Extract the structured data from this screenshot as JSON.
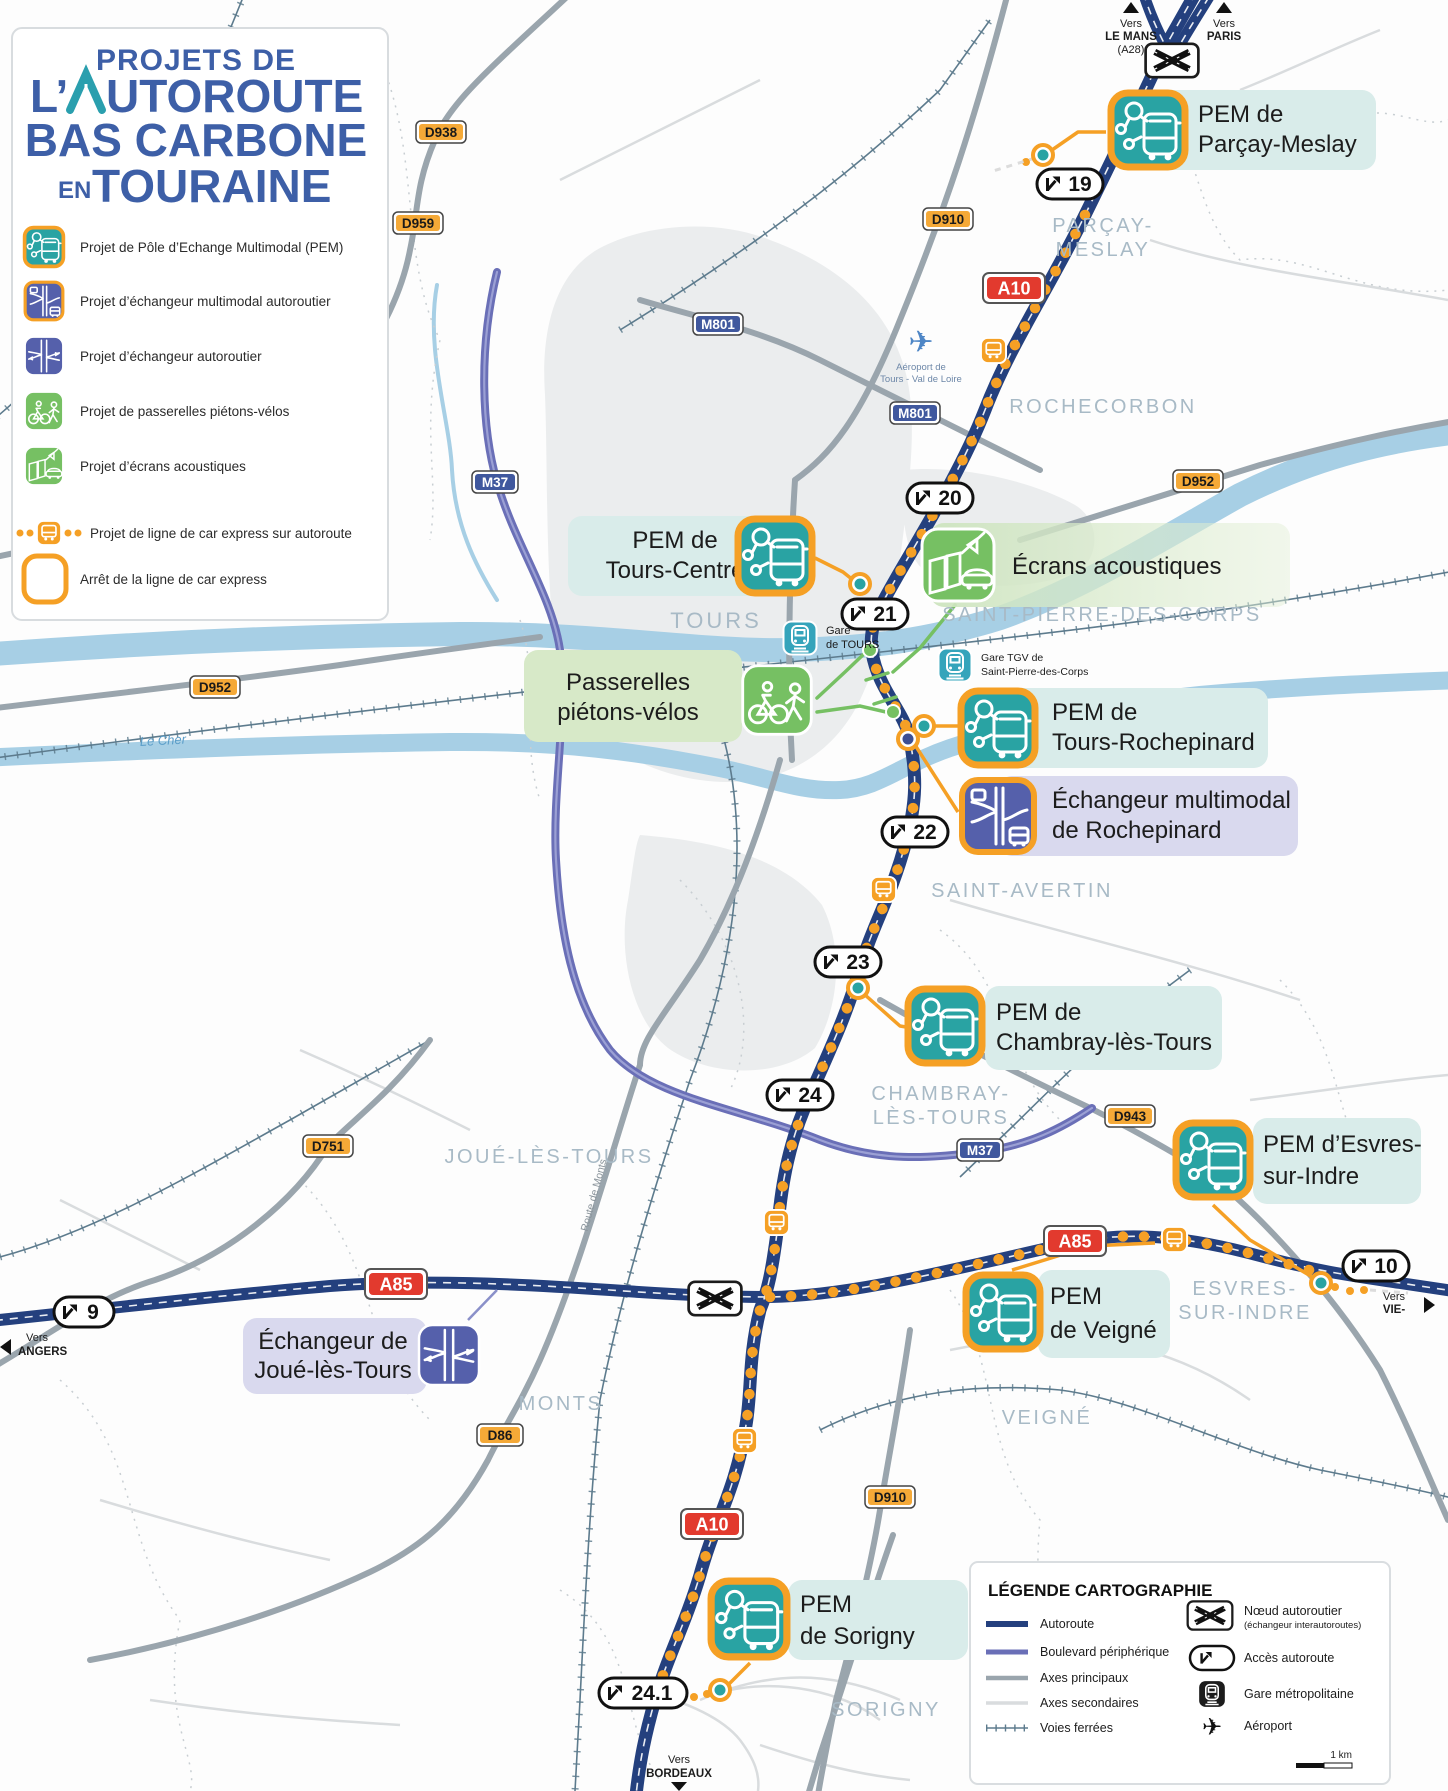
{
  "title_box": {
    "line1": "PROJETS DE",
    "line2_prefix": "L’",
    "line2_rest": "UTOROUTE",
    "line3": "BAS CARBONE",
    "line4_prefix": "EN",
    "line4_rest": "TOURAINE",
    "legend_items": [
      {
        "icon": "pem-icon",
        "label": "Projet de Pôle d’Echange Multimodal (PEM)"
      },
      {
        "icon": "echangeur-multimodal-icon",
        "label": "Projet d’échangeur multimodal autoroutier"
      },
      {
        "icon": "echangeur-autoroutier-icon",
        "label": "Projet d’échangeur autoroutier"
      },
      {
        "icon": "passerelles-icon",
        "label": "Projet de passerelles piétons-vélos"
      },
      {
        "icon": "ecrans-acoustiques-icon",
        "label": "Projet d’écrans acoustiques"
      },
      {
        "icon": "car-express-icon",
        "label": "Projet de ligne de car express sur autoroute"
      },
      {
        "icon": "arret-car-express-icon",
        "label": "Arrêt de la ligne de car express"
      }
    ]
  },
  "callouts": [
    {
      "kind": "pem",
      "lines": [
        "PEM de",
        "Parçay-Meslay"
      ]
    },
    {
      "kind": "pem",
      "lines": [
        "PEM de",
        "Tours-Centre"
      ]
    },
    {
      "kind": "ecrans",
      "lines": [
        "Écrans acoustiques"
      ]
    },
    {
      "kind": "passerelles",
      "lines": [
        "Passerelles",
        "piétons-vélos"
      ]
    },
    {
      "kind": "pem",
      "lines": [
        "PEM de",
        "Tours-Rochepinard"
      ]
    },
    {
      "kind": "echangeur",
      "lines": [
        "Échangeur multimodal",
        "de Rochepinard"
      ]
    },
    {
      "kind": "pem",
      "lines": [
        "PEM de",
        "Chambray-lès-Tours"
      ]
    },
    {
      "kind": "pem",
      "lines": [
        "PEM d’Esvres-",
        "sur-Indre"
      ]
    },
    {
      "kind": "pem",
      "lines": [
        "PEM",
        "de Veigné"
      ]
    },
    {
      "kind": "echangeur",
      "lines": [
        "Échangeur de",
        "Joué-lès-Tours"
      ]
    },
    {
      "kind": "pem",
      "lines": [
        "PEM",
        "de Sorigny"
      ]
    }
  ],
  "junctions": [
    "19",
    "20",
    "21",
    "22",
    "23",
    "24",
    "24.1",
    "9",
    "10"
  ],
  "road_badges": {
    "d": [
      "D938",
      "D959",
      "D910",
      "D952",
      "D952",
      "D751",
      "D943",
      "D86",
      "D910"
    ],
    "m": [
      "M801",
      "M801",
      "M37",
      "M37"
    ],
    "a": [
      "A10",
      "A10",
      "A85",
      "A85"
    ]
  },
  "cities": [
    [
      "PARÇAY-",
      "MESLAY"
    ],
    [
      "ROCHECORBON"
    ],
    [
      "TOURS"
    ],
    [
      "SAINT-PIERRE-DES-CORPS"
    ],
    [
      "SAINT-AVERTIN"
    ],
    [
      "CHAMBRAY-",
      "LÈS-TOURS"
    ],
    [
      "JOUÉ-LÈS-TOURS"
    ],
    [
      "ESVRES-",
      "SUR-INDRE"
    ],
    [
      "MONTS"
    ],
    [
      "VEIGNÉ"
    ],
    [
      "SORIGNY"
    ]
  ],
  "directions": [
    [
      "Vers",
      "LE MANS",
      "(A28)"
    ],
    [
      "Vers",
      "PARIS"
    ],
    [
      "Vers",
      "VIE-"
    ],
    [
      "Vers",
      "ANGERS"
    ],
    [
      "Vers",
      "BORDEAUX"
    ]
  ],
  "stations": {
    "gare_tours": [
      "Gare",
      "de TOURS"
    ],
    "gare_tgv": [
      "Gare TGV de",
      "Saint-Pierre-des-Corps"
    ],
    "airport": [
      "Aéroport de",
      "Tours - Val de Loire"
    ]
  },
  "rivers": {
    "loire": "La Loire",
    "cher": "Le Cher"
  },
  "minor_labels": {
    "route_de_monts": "Route de Monts"
  },
  "legend_carto": {
    "title": "LÉGENDE CARTOGRAPHIE",
    "lines": [
      {
        "label": "Autoroute"
      },
      {
        "label": "Boulevard périphérique"
      },
      {
        "label": "Axes principaux"
      },
      {
        "label": "Axes secondaires"
      },
      {
        "label": "Voies ferrées"
      }
    ],
    "symbols": [
      {
        "label": "Nœud autoroutier",
        "sub": "(échangeur interautoroutes)"
      },
      {
        "label": "Accès autoroute"
      },
      {
        "label": "Gare métropolitaine"
      },
      {
        "label": "Aéroport"
      }
    ],
    "scale_label": "1 km"
  },
  "colors": {
    "motorway": "#24407e",
    "peripherique": "#6a6fb7",
    "principal": "#9aa5ad",
    "secondary": "#d9dcde",
    "rail": "#5d7b8d",
    "river": "#a7cfe5",
    "express_orange": "#f5a025",
    "pem_teal": "#29a3a3",
    "echangeur_indigo": "#5560ab",
    "project_green": "#76c063",
    "band_teal": "#d9ecea",
    "band_green": "#d7e9c8",
    "band_purple": "#d9d9ee",
    "city_gray": "#a8bac6",
    "badge_d": "#f5a937",
    "badge_m": "#40589e",
    "badge_a": "#e23a2e"
  }
}
